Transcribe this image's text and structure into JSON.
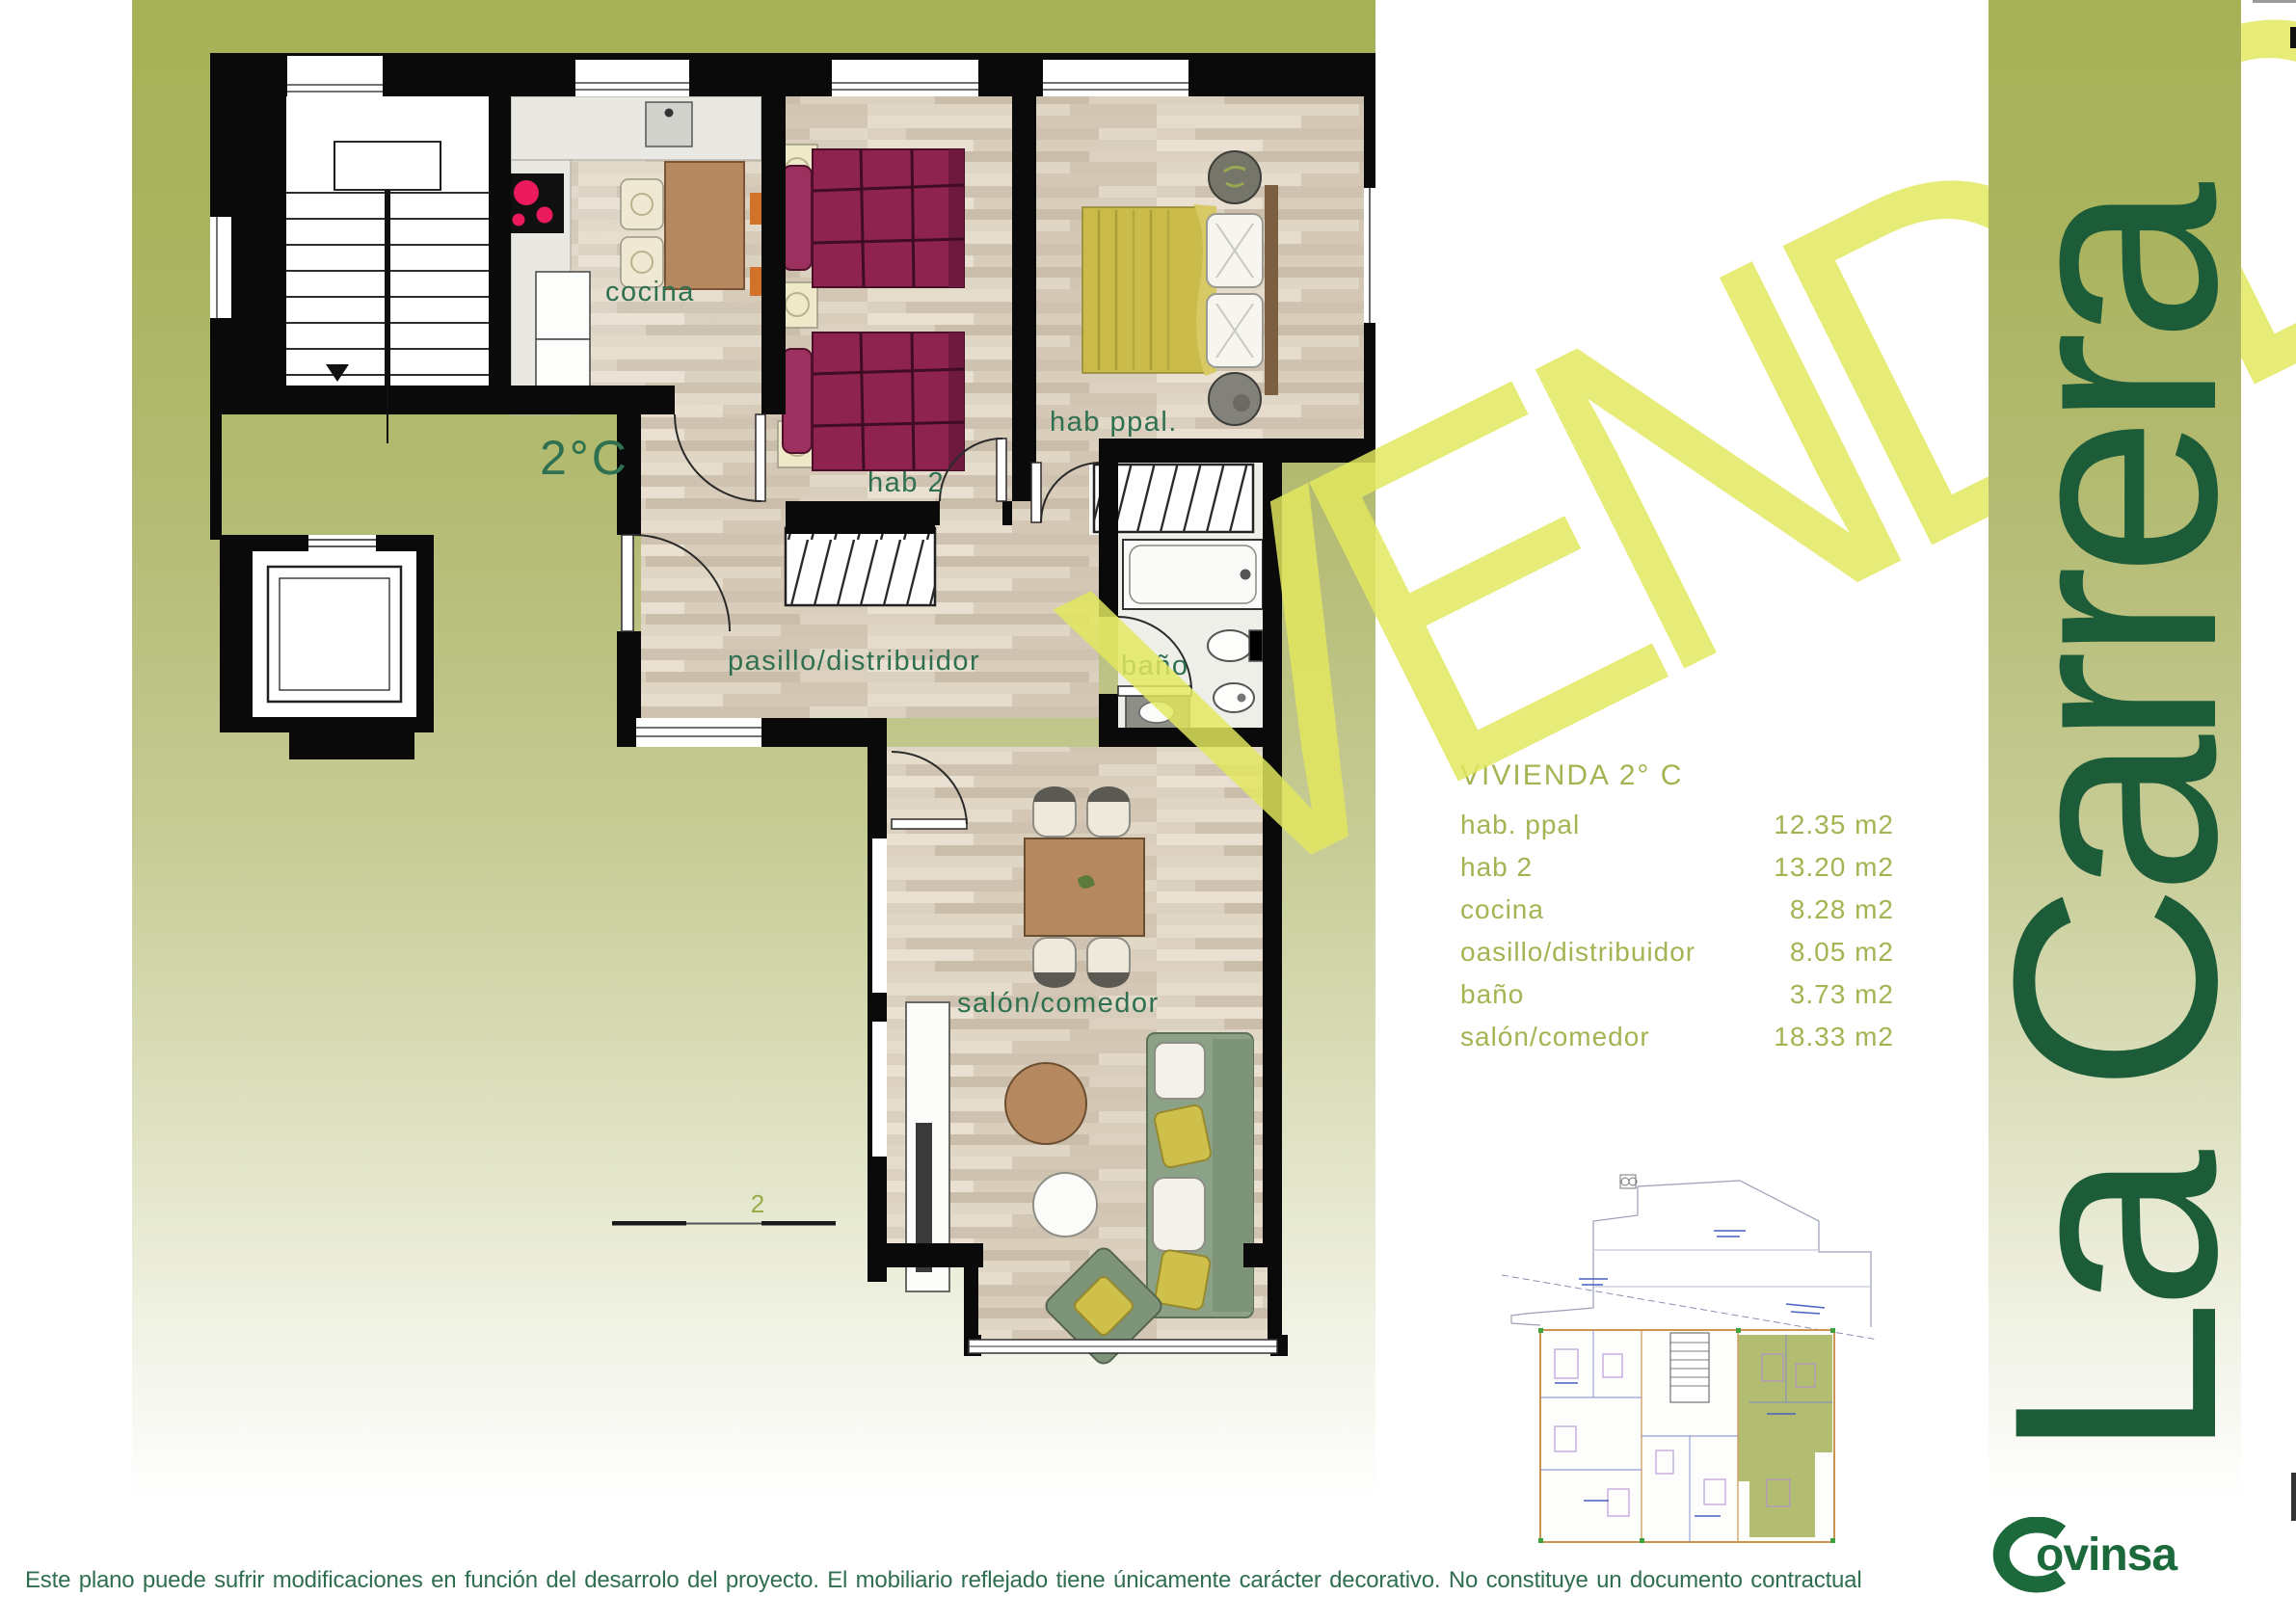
{
  "watermark": {
    "text": "VENDIDO",
    "color": "#e0e55e"
  },
  "sidebar": {
    "title": "La Carrera",
    "text_color": "#1d5c38"
  },
  "floorplan": {
    "unit_label": "2°C",
    "labels": {
      "kitchen": "cocina",
      "bedroom2": "hab 2",
      "master_bedroom": "hab ppal.",
      "hall": "pasillo/distribuidor",
      "bathroom": "baño",
      "living_room": "salón/comedor"
    },
    "scale_label": "2",
    "label_color": "#2e7050"
  },
  "info_table": {
    "title": "VIVIENDA 2° C",
    "text_color": "#a6b352",
    "rows": [
      {
        "name": "hab. ppal",
        "value": "12.35 m2"
      },
      {
        "name": "hab 2",
        "value": "13.20 m2"
      },
      {
        "name": "cocina",
        "value": "8.28 m2"
      },
      {
        "name": "oasillo/distribuidor",
        "value": "8.05 m2"
      },
      {
        "name": "baño",
        "value": "3.73 m2"
      },
      {
        "name": "salón/comedor",
        "value": "18.33 m2"
      }
    ]
  },
  "footer": {
    "brand_suffix": "ovinsa",
    "brand_name": "Covinsa",
    "brand_color": "#1c693c",
    "disclaimer": "Este plano puede sufrir modificaciones en función del desarrolo del proyecto. El mobiliario reflejado tiene únicamente carácter decorativo. No constituye un documento contractual",
    "disclaimer_color": "#2f6e50"
  }
}
